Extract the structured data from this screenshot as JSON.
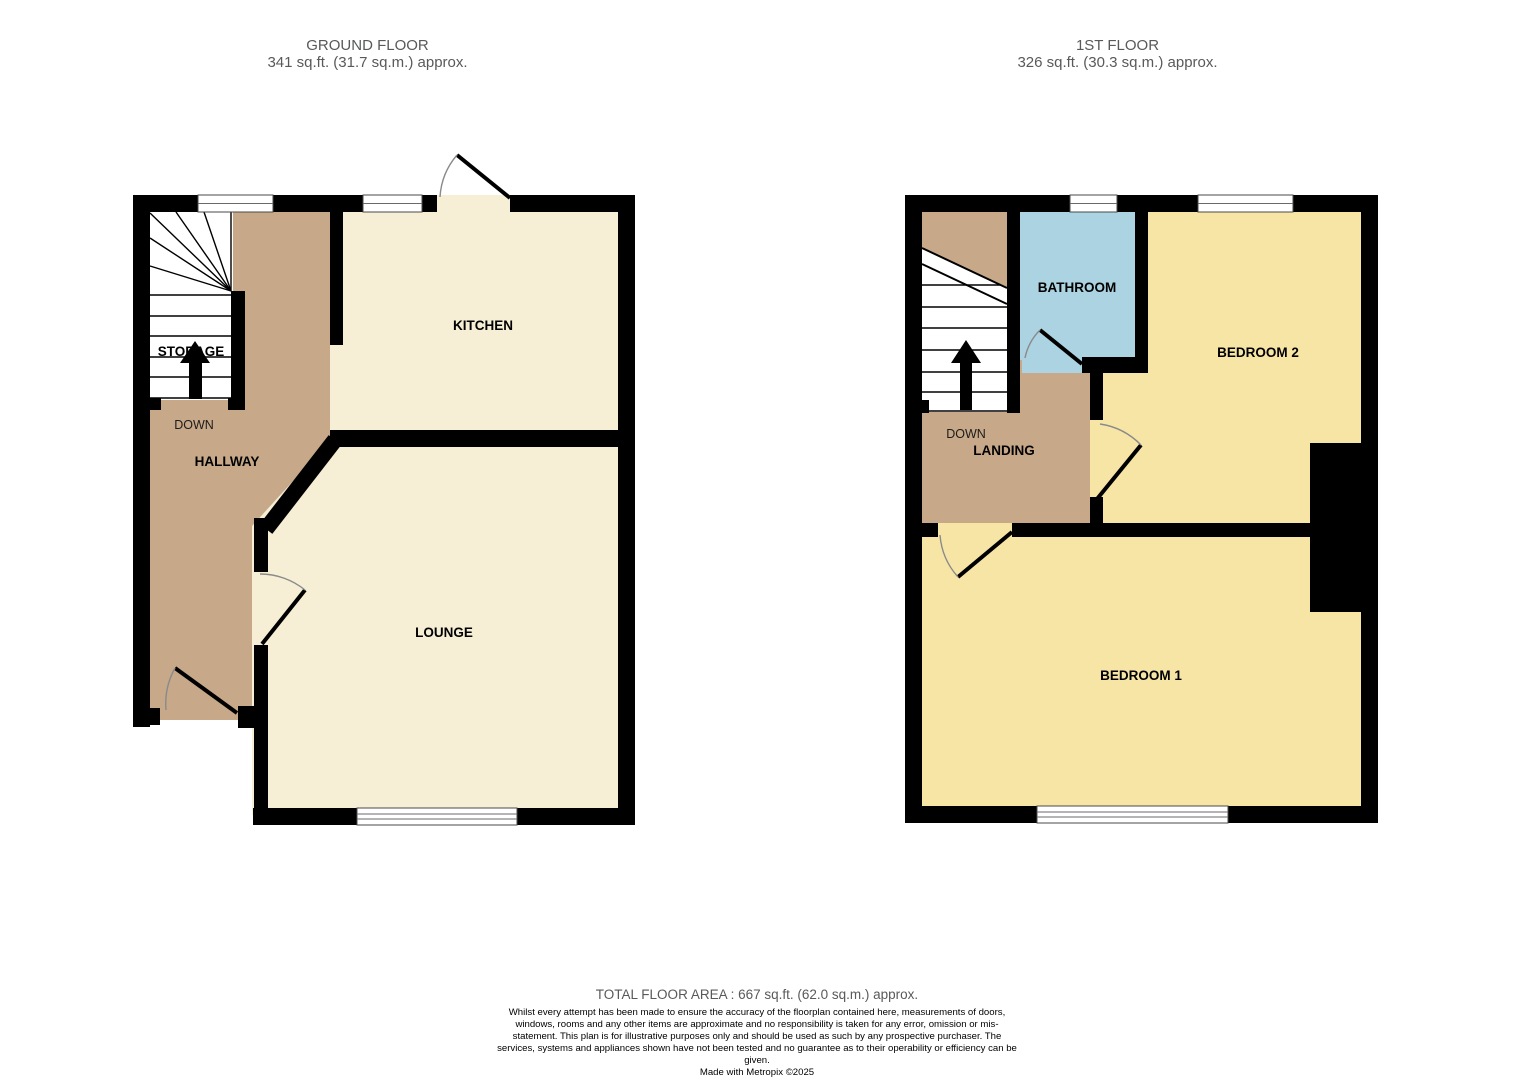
{
  "ground_floor": {
    "title": "GROUND FLOOR",
    "area": "341 sq.ft. (31.7 sq.m.) approx.",
    "rooms": {
      "kitchen": "KITCHEN",
      "lounge": "LOUNGE",
      "hallway": "HALLWAY",
      "storage": "STORAGE",
      "stairs_direction": "DOWN"
    }
  },
  "first_floor": {
    "title": "1ST FLOOR",
    "area": "326 sq.ft. (30.3 sq.m.) approx.",
    "rooms": {
      "bathroom": "BATHROOM",
      "bedroom2": "BEDROOM 2",
      "bedroom1": "BEDROOM 1",
      "landing": "LANDING",
      "stairs_direction": "DOWN"
    }
  },
  "footer": {
    "total_area": "TOTAL FLOOR AREA : 667 sq.ft. (62.0 sq.m.) approx.",
    "disclaimer": "Whilst every attempt has been made to ensure the accuracy of the floorplan contained here, measurements of doors, windows, rooms and any other items are approximate and no responsibility is taken for any error, omission or mis-statement. This plan is for illustrative purposes only and should be used as such by any prospective purchaser. The services, systems and appliances shown have not been tested and no guarantee as to their operability or efficiency can be given.",
    "credit": "Made with Metropix ©2025"
  },
  "colors": {
    "wall": "#000000",
    "hallway_landing": "#c7a888",
    "kitchen_lounge": "#f6efd6",
    "bedrooms": "#f7e5a6",
    "bathroom": "#abd3e1",
    "header_text": "#58595b"
  }
}
